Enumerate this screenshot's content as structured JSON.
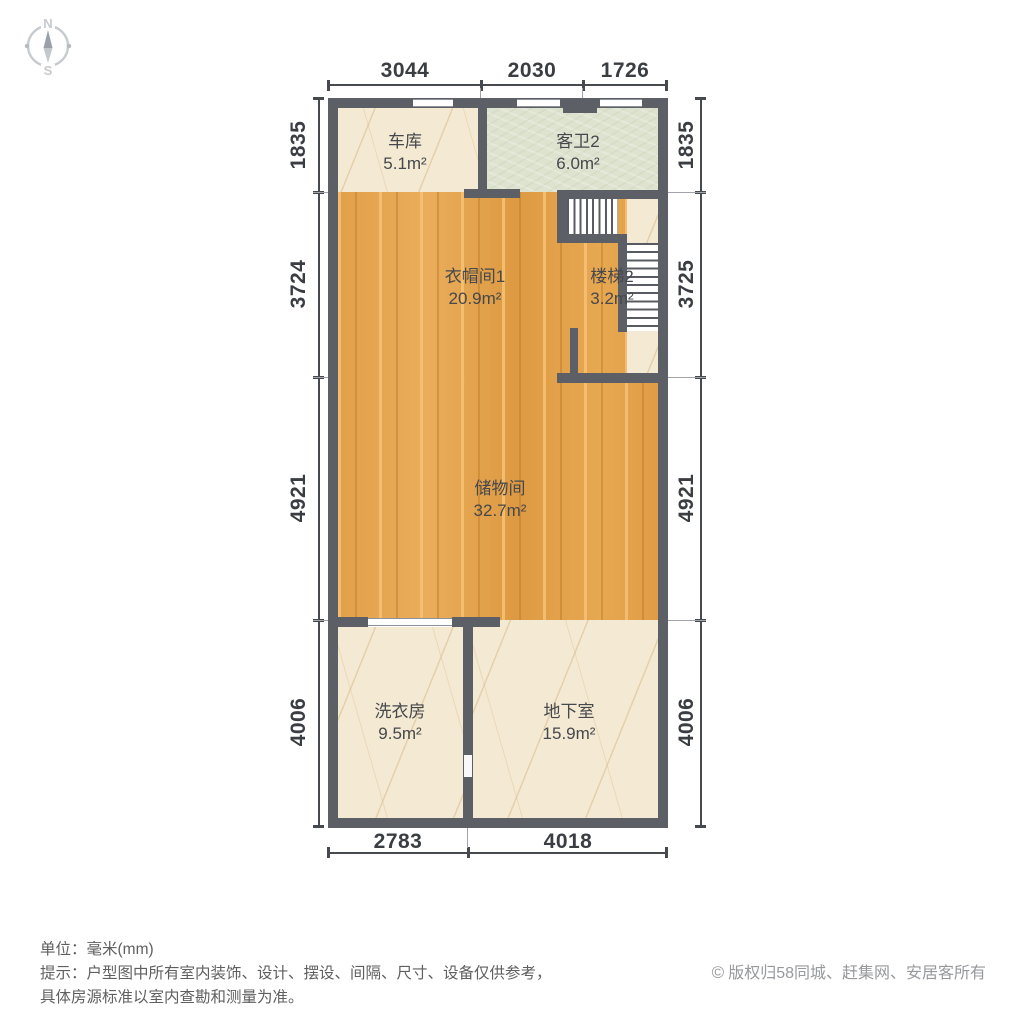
{
  "compass": {
    "north_label": "N",
    "south_label": "S"
  },
  "rooms": [
    {
      "id": "garage",
      "name": "车库",
      "area": "5.1m²"
    },
    {
      "id": "bath2",
      "name": "客卫2",
      "area": "6.0m²"
    },
    {
      "id": "cloakroom1",
      "name": "衣帽间1",
      "area": "20.9m²"
    },
    {
      "id": "stairs2",
      "name": "楼梯2",
      "area": "3.2m²"
    },
    {
      "id": "storage",
      "name": "储物间",
      "area": "32.7m²"
    },
    {
      "id": "laundry",
      "name": "洗衣房",
      "area": "9.5m²"
    },
    {
      "id": "basement",
      "name": "地下室",
      "area": "15.9m²"
    }
  ],
  "dimensions": {
    "top": [
      "3044",
      "2030",
      "1726"
    ],
    "left": [
      "1835",
      "3724",
      "4921",
      "4006"
    ],
    "right": [
      "1835",
      "3725",
      "4921",
      "4006"
    ],
    "bottom": [
      "2783",
      "4018"
    ]
  },
  "footer": {
    "unit_label": "单位：毫米(mm)",
    "disclaimer_line1": "提示：户型图中所有室内装饰、设计、摆设、间隔、尺寸、设备仅供参考，",
    "disclaimer_line2": "具体房源标准以室内查勘和测量为准。"
  },
  "copyright": {
    "symbol": "©",
    "text": "版权归58同城、赶集网、安居客所有"
  },
  "colors": {
    "wall": "#5c6066",
    "wood_floor": "#e2a04a",
    "marble_floor": "#f4e9d2",
    "tile_floor": "#dee3cf",
    "dimension_text": "#3a3d41",
    "footer_text": "#5f5f5f",
    "copyright_text": "#97999c"
  }
}
